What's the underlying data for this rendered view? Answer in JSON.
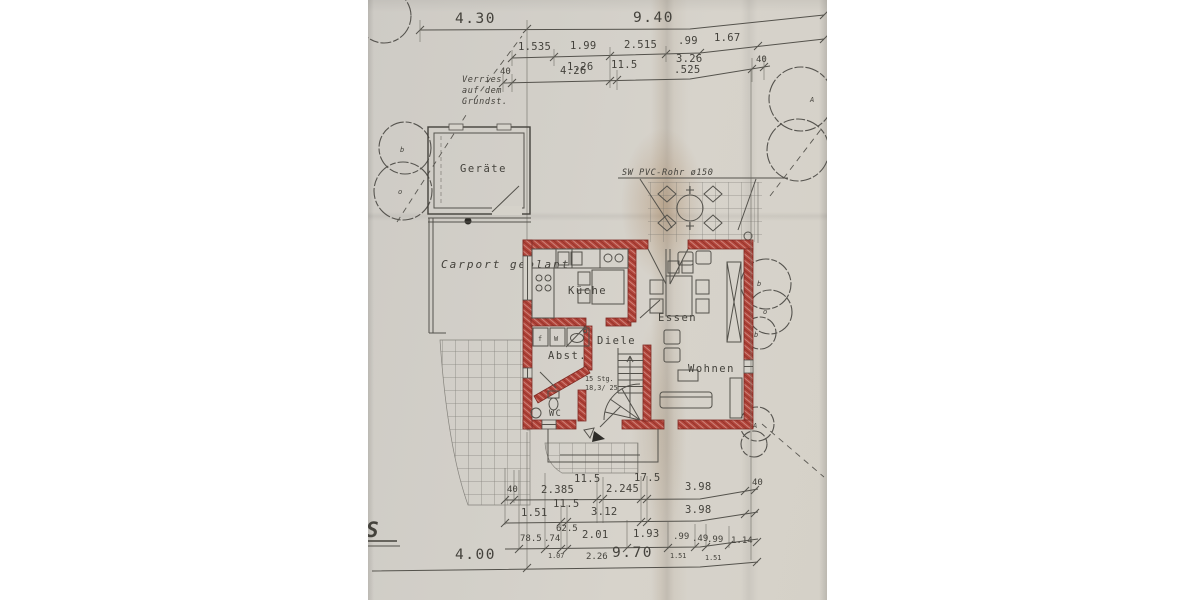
{
  "labels": {
    "note1": "Verries",
    "note2": "auf dem",
    "note3": "Grundst.",
    "shed": "Geräte",
    "carport": "Carport geplant",
    "pipe": "SW PVC-Rohr ø150",
    "fragment": "S"
  },
  "rooms": {
    "kitchen": "Küche",
    "dining": "Essen",
    "hall": "Diele",
    "storage": "Abst.",
    "wc": "WC",
    "living": "Wohnen"
  },
  "stairs": {
    "line1": "15 Stg.",
    "line2": "18,3/ 25"
  },
  "appliances": {
    "f": "f",
    "w": "W"
  },
  "trees": {
    "m_a": "A",
    "m_o": "o",
    "m_b": "b"
  },
  "dims": {
    "d430": "4.30",
    "d940": "9.40",
    "d1535": "1.535",
    "d199": "1.99",
    "d2515": "2.515",
    "d99": ".99",
    "d167": "1.67",
    "d126": "1.26",
    "d326": "3.26",
    "d40": "40",
    "d426": "4.26",
    "d115": "11.5",
    "d525": ".525",
    "d175": "17.5",
    "d2385": "2.385",
    "d2245": "2.245",
    "d398": "3.98",
    "d151": "1.51",
    "d312": "3.12",
    "d625": "62.5",
    "d785": "78.5",
    "d74": ".74",
    "d201": "2.01",
    "d193": "1.93",
    "d49": ".49",
    "d114": "1.14",
    "d107": "1.07",
    "d226": "2.26",
    "d400": "4.00",
    "d970": "9.70"
  },
  "colors": {
    "wall_red": "#b2463c",
    "ink": "#44423c",
    "paper": "#d4d1c9"
  }
}
